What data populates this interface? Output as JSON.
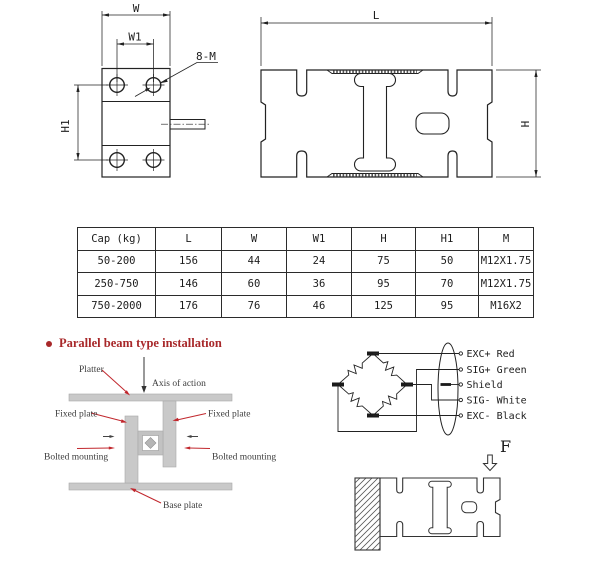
{
  "end_view": {
    "w": "W",
    "w1": "W1",
    "h1": "H1",
    "thread": "8-M"
  },
  "side_view": {
    "l": "L",
    "h": "H"
  },
  "spec_table": {
    "headers": [
      "Cap (kg)",
      "L",
      "W",
      "W1",
      "H",
      "H1",
      "M"
    ],
    "rows": [
      [
        "50-200",
        "156",
        "44",
        "24",
        "75",
        "50",
        "M12X1.75"
      ],
      [
        "250-750",
        "146",
        "60",
        "36",
        "95",
        "70",
        "M12X1.75"
      ],
      [
        "750-2000",
        "176",
        "76",
        "46",
        "125",
        "95",
        "M16X2"
      ]
    ]
  },
  "installation": {
    "title": "Parallel beam type installation",
    "platter": "Platter",
    "axis": "Axis of action",
    "fixed_left": "Fixed plate",
    "fixed_right": "Fixed plate",
    "bolted_left": "Bolted mounting",
    "bolted_right": "Bolted mounting",
    "base": "Base plate"
  },
  "wiring": {
    "labels": [
      "EXC+ Red",
      "SIG+ Green",
      "Shield",
      "SIG- White",
      "EXC- Black"
    ]
  },
  "force": {
    "label": "F"
  },
  "colors": {
    "accent_red": "#a8282a",
    "leader_red": "#c1272d",
    "steel_gray": "#c9c9c9",
    "line_black": "#222222"
  }
}
